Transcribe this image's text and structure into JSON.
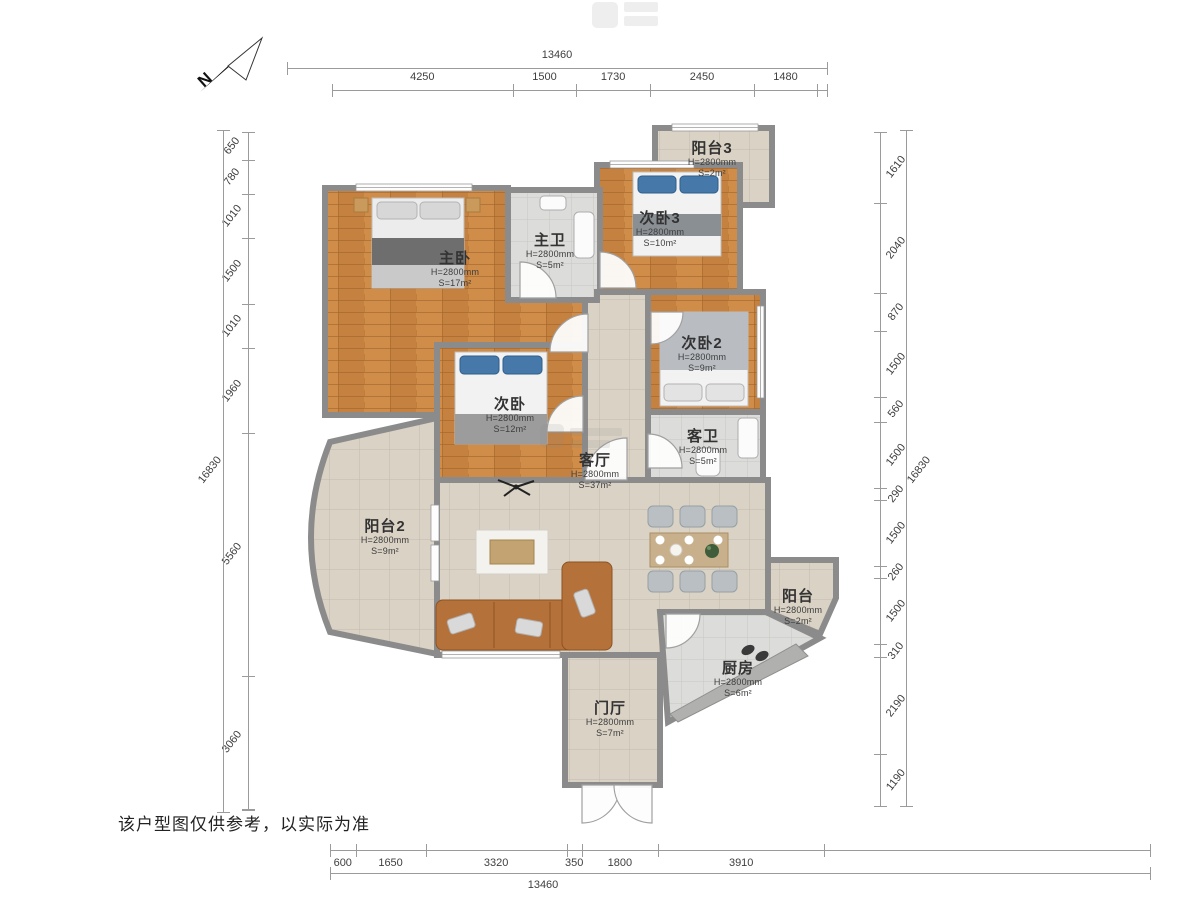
{
  "north": {
    "label": "N"
  },
  "disclaimer": "该户型图仅供参考，以实际为准",
  "dimensions": {
    "top": {
      "total": "13460",
      "segments": [
        "4250",
        "1500",
        "1730",
        "2450",
        "1480"
      ]
    },
    "bottom": {
      "total": "13460",
      "segments": [
        "600",
        "1650",
        "3320",
        "350",
        "1800",
        "3910"
      ]
    },
    "left": {
      "total": "16830",
      "segments": [
        "650",
        "780",
        "1010",
        "1500",
        "1010",
        "1960",
        "5560",
        "3060"
      ]
    },
    "right": {
      "total": "16830",
      "segments": [
        "1610",
        "2040",
        "870",
        "1500",
        "560",
        "1500",
        "290",
        "1500",
        "260",
        "1500",
        "310",
        "2190",
        "1190"
      ]
    }
  },
  "rooms": {
    "balcony3": {
      "name": "阳台3",
      "h": "H=2800mm",
      "s": "S=2m²"
    },
    "bedroom3": {
      "name": "次卧3",
      "h": "H=2800mm",
      "s": "S=10m²"
    },
    "master_bath": {
      "name": "主卫",
      "h": "H=2800mm",
      "s": "S=5m²"
    },
    "master": {
      "name": "主卧",
      "h": "H=2800mm",
      "s": "S=17m²"
    },
    "bedroom2": {
      "name": "次卧2",
      "h": "H=2800mm",
      "s": "S=9m²"
    },
    "bedroom_mid": {
      "name": "次卧",
      "h": "H=2800mm",
      "s": "S=12m²"
    },
    "guest_bath": {
      "name": "客卫",
      "h": "H=2800mm",
      "s": "S=5m²"
    },
    "living": {
      "name": "客厅",
      "h": "H=2800mm",
      "s": "S=37m²"
    },
    "balcony2": {
      "name": "阳台2",
      "h": "H=2800mm",
      "s": "S=9m²"
    },
    "balcony": {
      "name": "阳台",
      "h": "H=2800mm",
      "s": "S=2m²"
    },
    "kitchen": {
      "name": "厨房",
      "h": "H=2800mm",
      "s": "S=6m²"
    },
    "foyer": {
      "name": "门厅",
      "h": "H=2800mm",
      "s": "S=7m²"
    }
  },
  "colors": {
    "wall": "#8b8b8b",
    "wood": "#c5813f",
    "tile_beige": "#d9d2c5",
    "tile_gray": "#dcdcda",
    "sofa": "#b5713a",
    "pillow_blue": "#4679a9"
  }
}
